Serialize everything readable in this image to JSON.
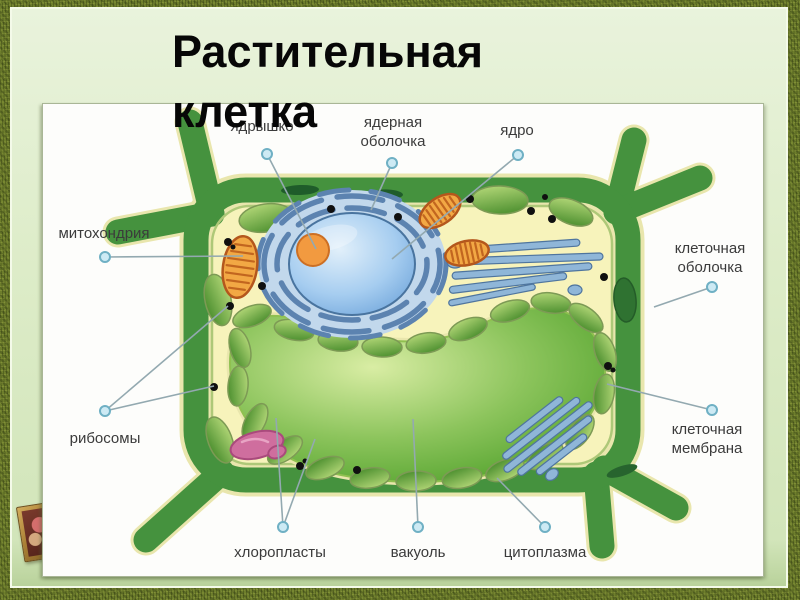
{
  "slide": {
    "title": "Растительная клетка",
    "title_line1": "Растительная",
    "title_line2": "клетка"
  },
  "diagram": {
    "labels": {
      "nucleolus": "ядрышко",
      "nuclear_envelope": "ядерная оболочка",
      "nucleus": "ядро",
      "mitochondria": "митохондрия",
      "cell_wall": "клеточная оболочка",
      "ribosomes": "рибосомы",
      "cell_membrane": "клеточная мембрана",
      "chloroplasts": "хлоропласты",
      "vacuole": "вакуоль",
      "cytoplasm": "цитоплазма"
    }
  },
  "icons": {
    "corner_ornament": "framed-picture-icon"
  },
  "colors": {
    "frame_texture_green": "#69792a",
    "mat_green": "#ddecc8",
    "panel_white": "#fdfdfb",
    "title_black": "#070707",
    "label_gray": "#3b3b3b",
    "leader_line_gray": "#93a9b0",
    "leader_dot_cyan": "#cdeaf4",
    "cell_wall_green": "#45923e",
    "cell_edge_cream": "#e9e6ad",
    "cytoplasm_yellow": "#f7f3bb",
    "vacuole_green": "#6db13e",
    "nucleus_blue": "#a6cdf0",
    "nucleolus_orange": "#f29a40",
    "er_golgi_blue": "#8fb6d8",
    "mitochondria_orange": "#f2a844",
    "chloroplast_green": "#7cb94e",
    "organelle_pink": "#cf6e9e",
    "ribosome_black": "#101010"
  }
}
